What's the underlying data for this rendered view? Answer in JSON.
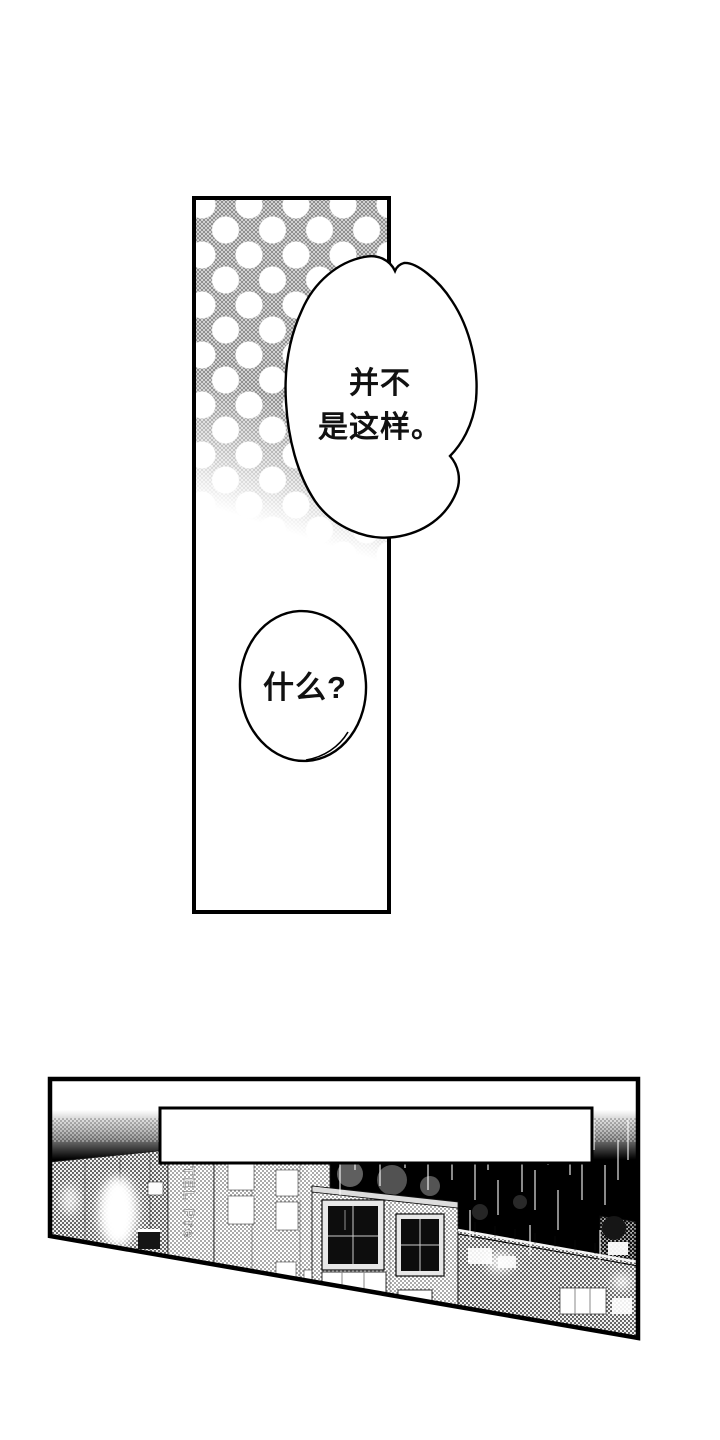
{
  "panel_top": {
    "cloud_bubble": {
      "line1": "并不",
      "line2": "是这样。"
    },
    "round_bubble": {
      "text": "什么?"
    }
  },
  "panel_bottom": {
    "caption_text": "",
    "hotel_sign": "OTEL Pre"
  },
  "colors": {
    "ink": "#000000",
    "paper": "#ffffff",
    "halftone_gray": "#909090"
  }
}
